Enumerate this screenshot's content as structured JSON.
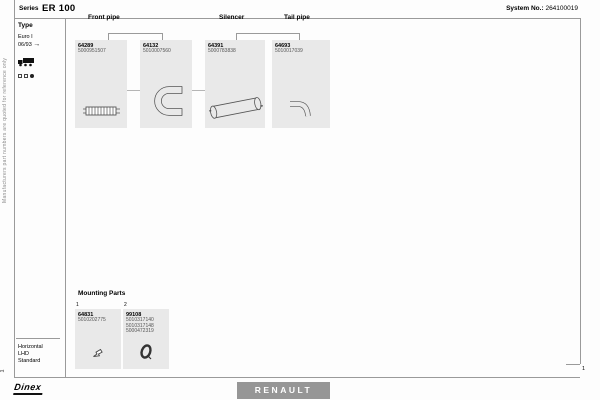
{
  "header": {
    "series_label": "Series",
    "series_value": "ER 100",
    "system_label": "System No.:",
    "system_value": "264100019"
  },
  "side_note": "Manufacturers part numbers are quoted for reference only",
  "sidebar": {
    "type_label": "Type",
    "variant": "Euro I",
    "date": "06/93",
    "arrow": "→",
    "footer": [
      "Horizontal",
      "LHD",
      "Standard"
    ]
  },
  "columns": [
    {
      "label": "Front pipe"
    },
    {
      "label": "Silencer"
    },
    {
      "label": "Tail pipe"
    }
  ],
  "parts": [
    {
      "id": "64289",
      "ref": "5000951507",
      "icon": "flex-pipe-icon"
    },
    {
      "id": "64132",
      "ref": "5010007560",
      "icon": "bent-pipe-icon"
    },
    {
      "id": "64391",
      "ref": "5000783838",
      "icon": "silencer-icon"
    },
    {
      "id": "64693",
      "ref": "5010017039",
      "icon": "tail-pipe-icon"
    }
  ],
  "mounting": {
    "title": "Mounting Parts",
    "items": [
      {
        "index": "1",
        "id": "64831",
        "refs": [
          "5010202775"
        ],
        "icon": "clamp-icon"
      },
      {
        "index": "2",
        "id": "99108",
        "refs": [
          "5010317140",
          "5010317148",
          "5000472319"
        ],
        "icon": "ring-clamp-icon"
      }
    ]
  },
  "footer": {
    "brand": "Dinex",
    "vehicle_make": "RENAULT",
    "page": "1",
    "page_left": "1"
  },
  "colors": {
    "box_fill": "#e9e9e9",
    "renault_bg": "#969696",
    "line": "#9a9a9a"
  }
}
